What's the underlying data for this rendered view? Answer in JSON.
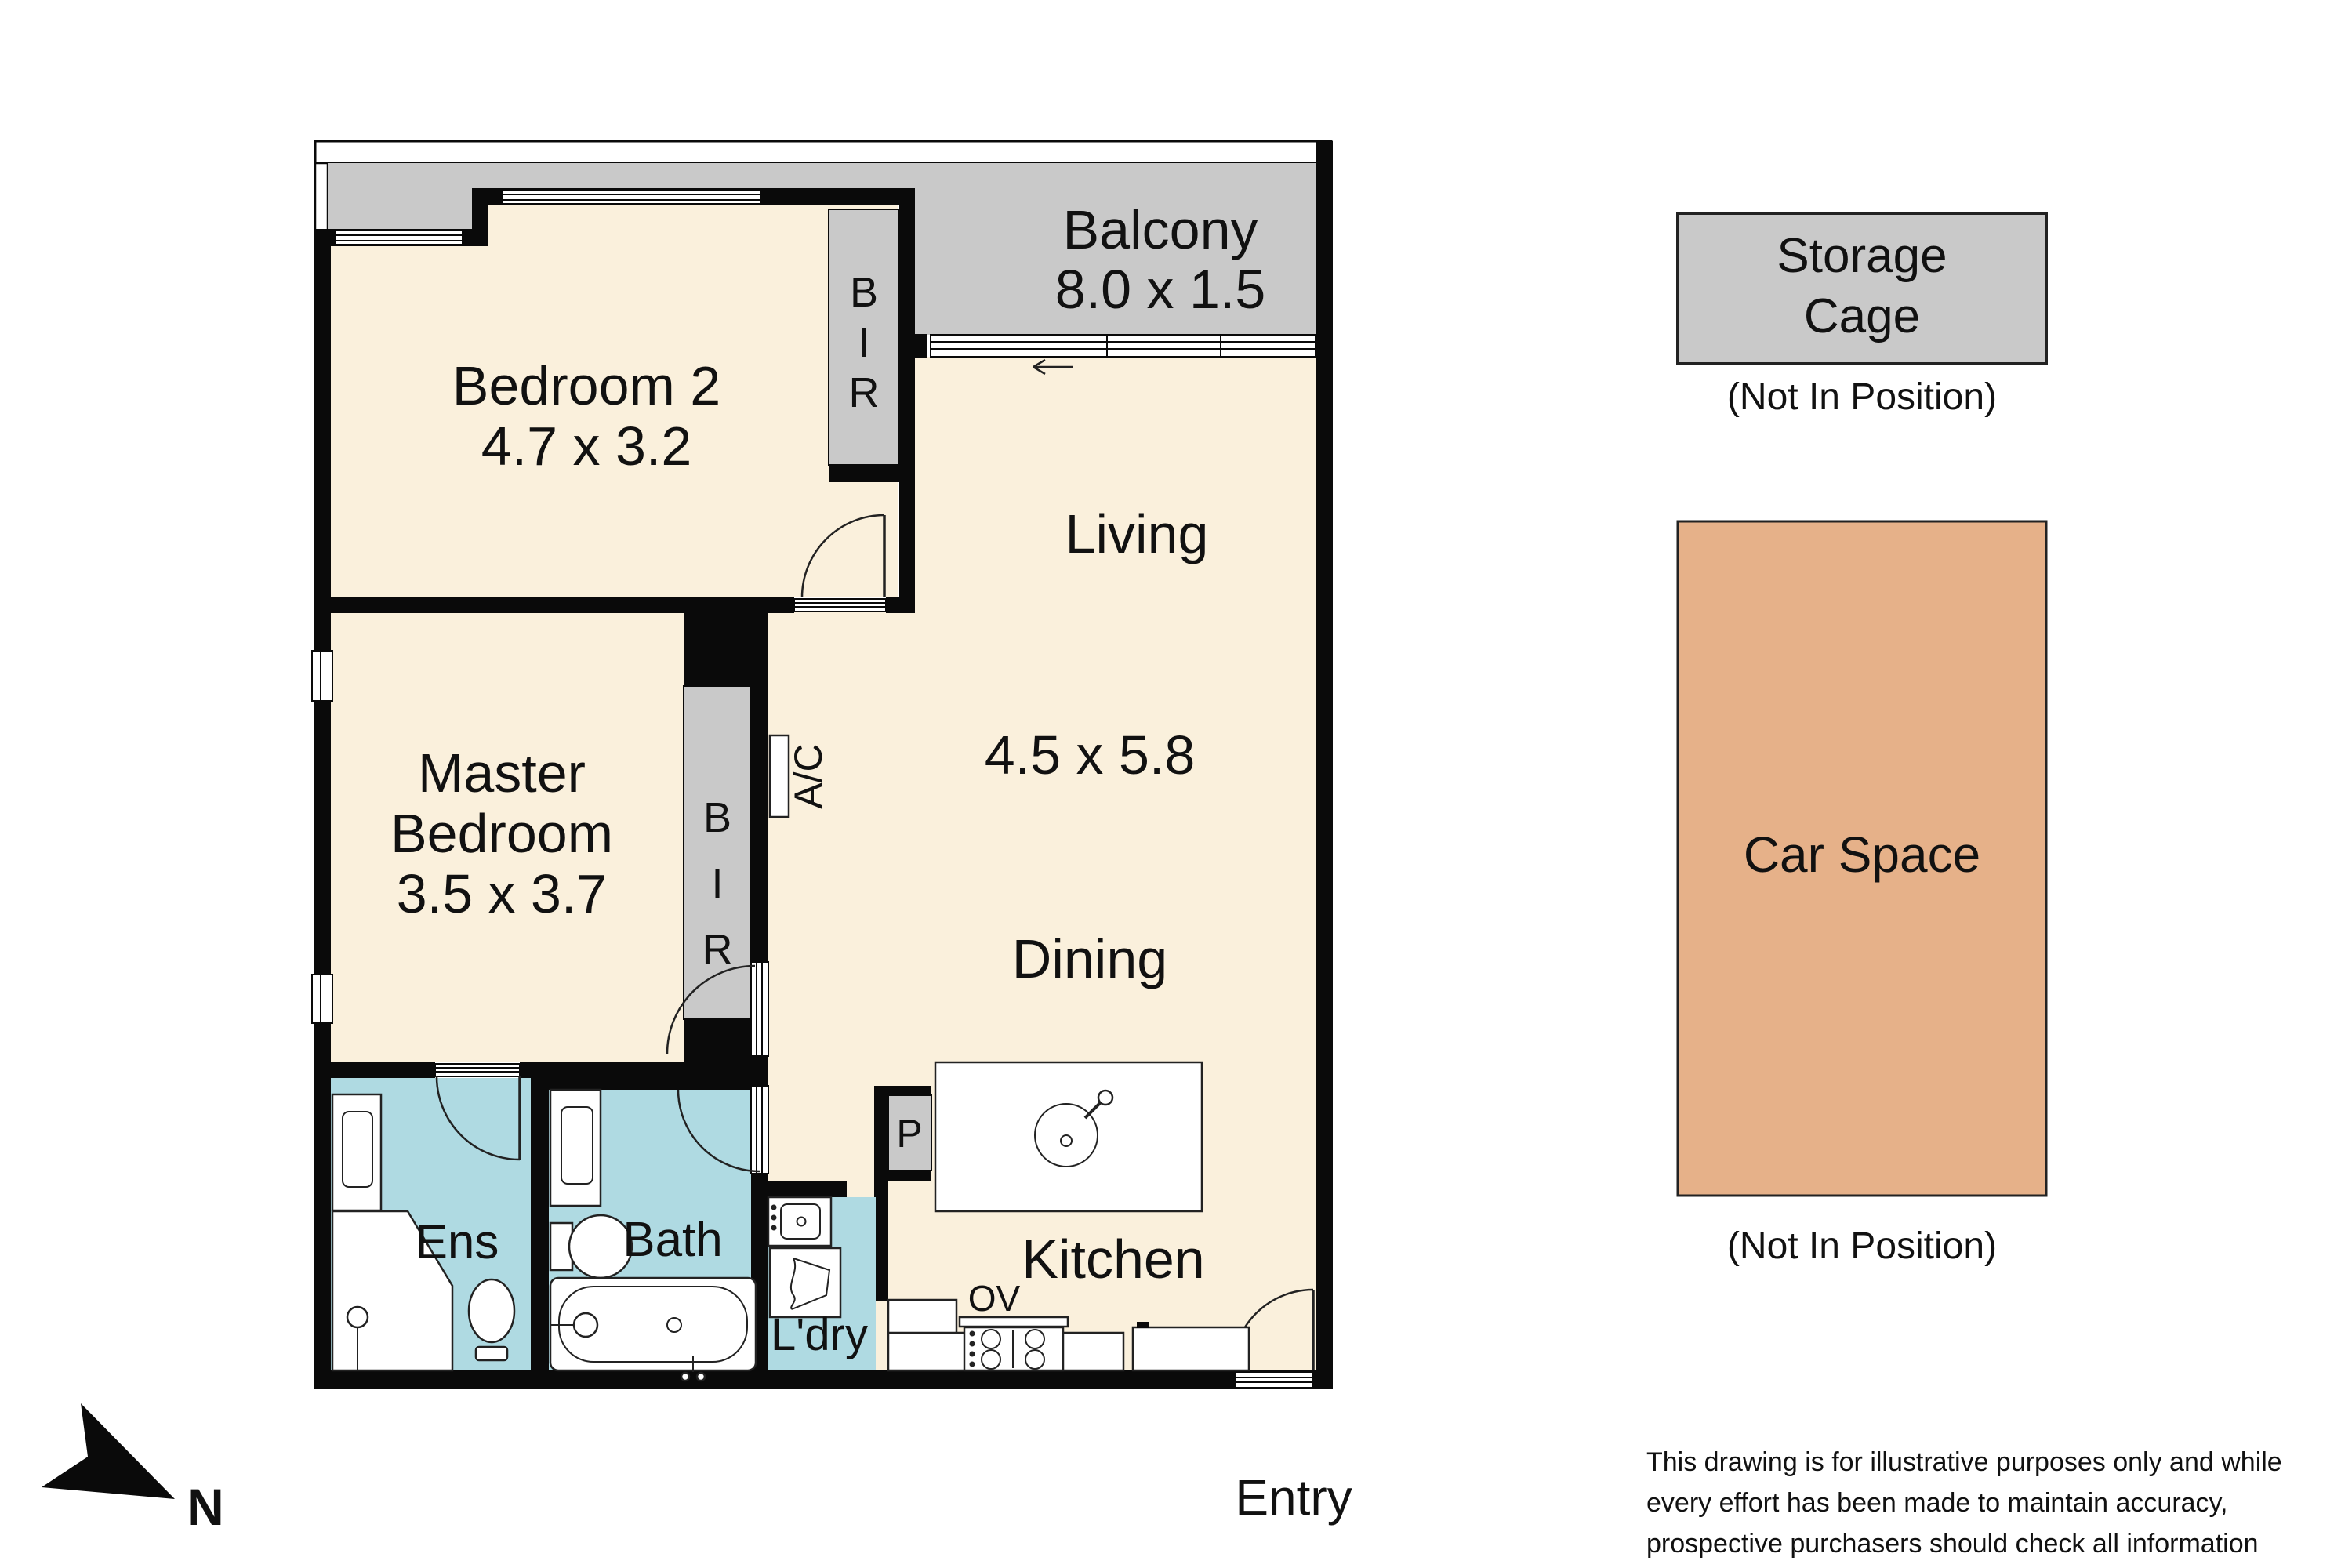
{
  "floorplan": {
    "bedroom2": {
      "name": "Bedroom 2",
      "dims": "4.7 x 3.2"
    },
    "master_bedroom": {
      "line1": "Master",
      "line2": "Bedroom",
      "dims": "3.5 x 3.7"
    },
    "living": {
      "name": "Living",
      "dims": "4.5 x 5.8"
    },
    "dining": {
      "name": "Dining"
    },
    "kitchen": {
      "name": "Kitchen",
      "oven": "OV",
      "pantry": "P"
    },
    "balcony": {
      "name": "Balcony",
      "dims": "8.0 x 1.5"
    },
    "ensuite": {
      "name": "Ens"
    },
    "bathroom": {
      "name": "Bath"
    },
    "laundry": {
      "name": "L'dry"
    },
    "entry": {
      "name": "Entry"
    },
    "wardrobe_letters": [
      "B",
      "I",
      "R"
    ],
    "ac_label": "A/C",
    "compass_north": "N"
  },
  "side_panel": {
    "storage_cage": {
      "line1": "Storage",
      "line2": "Cage",
      "note": "(Not In Position)"
    },
    "car_space": {
      "name": "Car Space",
      "note": "(Not In Position)"
    }
  },
  "disclaimer": {
    "line1": "This drawing is for illustrative purposes only and while",
    "line2": "every effort has been made to maintain accuracy,",
    "line3": "prospective purchasers should check all information"
  },
  "colors": {
    "floor_cream": "#FAF0DC",
    "balcony_gray": "#C9C9C9",
    "wet_area_blue": "#AFDAE2",
    "car_space_tan": "#E6B189",
    "wall_black": "#0A0A0A"
  }
}
